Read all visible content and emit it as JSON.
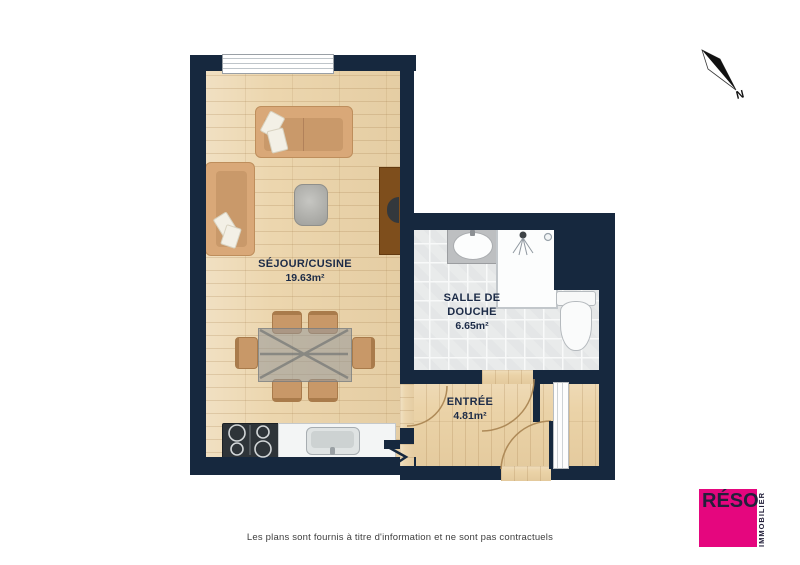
{
  "page": {
    "disclaimer": "Les plans sont fournis à titre d'information et ne sont pas contractuels"
  },
  "compass": {
    "label": "N"
  },
  "logo": {
    "brand": "RÉSO",
    "tagline": "IMMOBILIER",
    "brand_color": "#E5067E",
    "text_color": "#23203B"
  },
  "plan": {
    "wall_color": "#16283E",
    "rooms": [
      {
        "id": "sejour_cuisine",
        "name": "SÉJOUR/CUSINE",
        "area": "19.63m²",
        "floor": "wood"
      },
      {
        "id": "salle_de_douche",
        "name": "SALLE DE DOUCHE",
        "area": "6.65m²",
        "floor": "tile"
      },
      {
        "id": "entree",
        "name": "ENTRÉE",
        "area": "4.81m²",
        "floor": "wood"
      }
    ],
    "fixtures": [
      "window",
      "sofa",
      "armchair",
      "coffee-table",
      "tv-cabinet",
      "tv",
      "dining-table",
      "dining-chairs",
      "stove",
      "kitchen-sink",
      "washbasin",
      "shower",
      "toilet",
      "closet",
      "entry-door",
      "bathroom-door",
      "sejour-door",
      "opening-chevron",
      "north-arrow"
    ]
  }
}
